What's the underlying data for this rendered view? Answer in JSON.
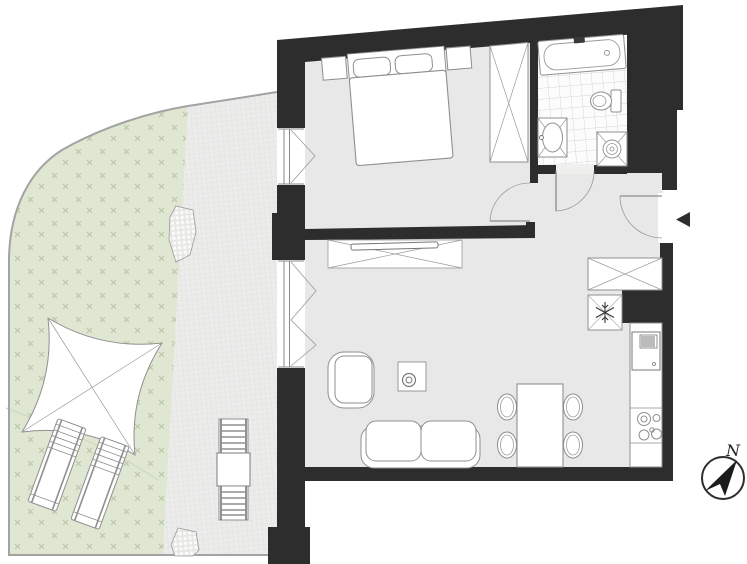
{
  "title": "apartment-floor-plan",
  "compass": {
    "label": "N"
  },
  "colors": {
    "wall": "#2d2d2d",
    "floor": "#e8e8e8",
    "bathroom_floor": "#fcfcfc",
    "tile_line": "#c8c8c8",
    "garden": "#dfe7d2",
    "grass_mark": "#b5c3a1",
    "terrace": "#ececeb",
    "terrace_grid": "#d9d9d9",
    "furniture_outline": "#8f8f8f",
    "boundary_line": "#a3a3a3",
    "background": "#ffffff"
  },
  "outdoor": {
    "elements": [
      "garden",
      "terrace",
      "shade-sail",
      "sun-lounger",
      "sun-lounger",
      "outdoor-table",
      "outdoor-chair",
      "outdoor-chair",
      "planter",
      "planter"
    ]
  },
  "fixtures": {
    "bedroom": [
      "double-bed",
      "pillow",
      "pillow",
      "nightstand",
      "nightstand",
      "wardrobe",
      "casement-window",
      "door"
    ],
    "bathroom": [
      "bathtub",
      "toilet",
      "washbasin",
      "shower",
      "door",
      "tiled-floor"
    ],
    "living_room": [
      "tv-sideboard",
      "tv",
      "armchair",
      "side-table",
      "sofa",
      "dining-table",
      "dining-chair",
      "dining-chair",
      "dining-chair",
      "dining-chair",
      "terrace-window"
    ],
    "kitchen": [
      "kitchen-counter",
      "oven",
      "cooktop",
      "refrigerator",
      "closet"
    ],
    "entry": [
      "entrance-door",
      "entrance-arrow"
    ]
  }
}
